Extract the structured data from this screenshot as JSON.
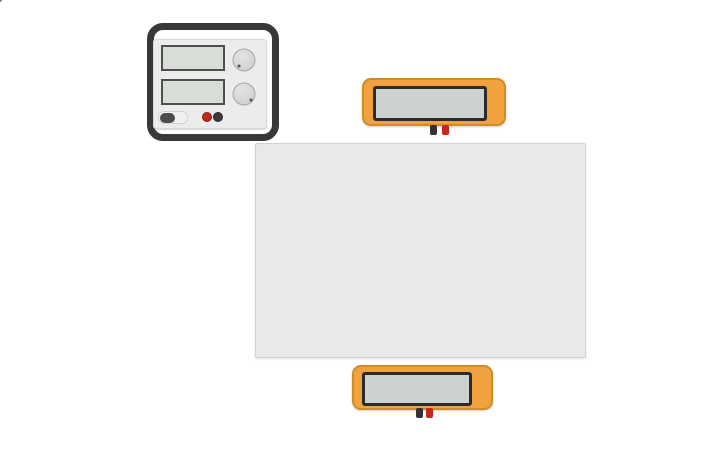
{
  "scene": {
    "background": "#ffffff",
    "app": "circuit-workspace"
  },
  "power_supply": {
    "toggle_label": "OFF",
    "brand": [
      "POWER",
      "SUPPLY"
    ],
    "bolt_icon": "⚡",
    "knobs": [
      {
        "name": "voltage-knob",
        "min": "0",
        "max": "30 V"
      },
      {
        "name": "current-knob",
        "min": "0",
        "max": "1 A"
      }
    ],
    "displays": [
      "",
      ""
    ],
    "colors": {
      "case": "#383838",
      "panel": "#ececec",
      "screen": "#d9ddd8",
      "terminal_red": "#c4281c",
      "terminal_black": "#3a3a3a"
    }
  },
  "multimeters": {
    "top": {
      "display": "",
      "buttons": [
        {
          "label": "A",
          "selected": true
        },
        {
          "label": "V",
          "selected": false
        },
        {
          "label": "R",
          "selected": false
        }
      ]
    },
    "bottom": {
      "display": "",
      "buttons": [
        {
          "label": "A",
          "selected": false
        },
        {
          "label": "V",
          "selected": true
        },
        {
          "label": "R",
          "selected": false
        }
      ]
    },
    "colors": {
      "body": "#efa23d",
      "border": "#d38b24",
      "screen": "#ccd2cf",
      "button": "#3a3a3a",
      "terminal_red": "#c4281c",
      "terminal_black": "#333333"
    }
  },
  "breadboard": {
    "columns": 30,
    "row_letters_top": [
      "j",
      "i",
      "h",
      "g",
      "f"
    ],
    "row_letters_bottom": [
      "e",
      "d",
      "c",
      "b",
      "a"
    ],
    "plus": "+",
    "minus": "–",
    "colors": {
      "board": "#e9e9e9",
      "hole": "#2e2e2e",
      "line_red": "#d8342c",
      "line_dark": "#3f3f3f",
      "label": "#8f8f8f"
    }
  },
  "components": {
    "resistor": {
      "body_color": "#c9a36a",
      "bands": [
        "#7a4a21",
        "#1d1d1d",
        "#c0392b",
        "#cfa14e"
      ],
      "lead_color": "#9a9a9a"
    },
    "diode": {
      "body_color": "#1e1e1e",
      "stripe_color": "#b9bdbf",
      "lead_color": "#9a9a9a"
    }
  },
  "wires": [
    {
      "name": "wire-ps-positive-to-rail",
      "color": "#d62c20",
      "width": 3.4,
      "path": "M207,120 L207,151 Q207,160 216.5,160 L272.5,160",
      "caps": [
        [
          272.5,
          160
        ]
      ],
      "cap_color": "#7e1d14"
    },
    {
      "name": "wire-ps-negative-to-j6",
      "color": "#2d2d2d",
      "width": 3.4,
      "path": "M218,121 L218,127 Q218,136.5 227.5,136.5 L316,136.5 Q325.5,136.5 325.5,146 L325.5,197.5",
      "caps": [
        [
          325.5,
          198
        ]
      ],
      "cap_color": "#0d0d0d"
    },
    {
      "name": "wire-offscreen-left-to-rail",
      "color": "#2d2d2d",
      "width": 3.4,
      "path": "M-2,169.5 L272.5,169.5",
      "caps": [
        [
          272.5,
          169.5
        ]
      ],
      "cap_color": "#0d0d0d"
    },
    {
      "name": "wire-offscreen-top-stub",
      "color": "#2d2d2d",
      "width": 3.4,
      "path": "M232,-2 L232,26",
      "caps": []
    },
    {
      "name": "wire-multimeter-top-red-to-j10",
      "color": "#d62c20",
      "width": 3.4,
      "path": "M443,127 L443,167 Q443,177.5 432.5,177.5 L376.5,177.5 Q366,177.5 366,188 L366,197.5",
      "caps": [
        [
          366,
          198
        ]
      ],
      "cap_color": "#7e1d14"
    },
    {
      "name": "wire-multimeter-black-loop-to-bottom-meter",
      "color": "#2d2d2d",
      "width": 3.4,
      "path": "M431,127 L431,131 Q431,133.5 427.5,133.5 L363,133.5 Q352.5,133.5 352.5,123 L352.5,80 Q352.5,68.5 364,68.5 L499,68.5 Q511.5,68.5 511.5,80 L511.5,108 C511.5,128 462,130 462,152 L462,216 C462,227 443.5,231 443.5,244 L443.5,311 Q443.5,322.5 432,322.5 L342,322.5 Q330.5,322.5 330.5,334 L330.5,404 Q330.5,416.5 342,416.5 L412,416.5 Q416.5,416.5 416.5,412",
      "caps": []
    },
    {
      "name": "wire-f13-red-to-bottom-meter",
      "color": "#d62c20",
      "width": 3.4,
      "path": "M402.5,238.5 L402.5,299 Q402.5,311.5 390,311.5 L319,311.5 Q307,311.5 307,323.5 L307,417 Q307,429 319,429 L415,429 Q427,429 427,417 L427,413",
      "caps": [
        [
          402.5,
          238.5
        ]
      ],
      "cap_color": "#7e1d14"
    }
  ]
}
